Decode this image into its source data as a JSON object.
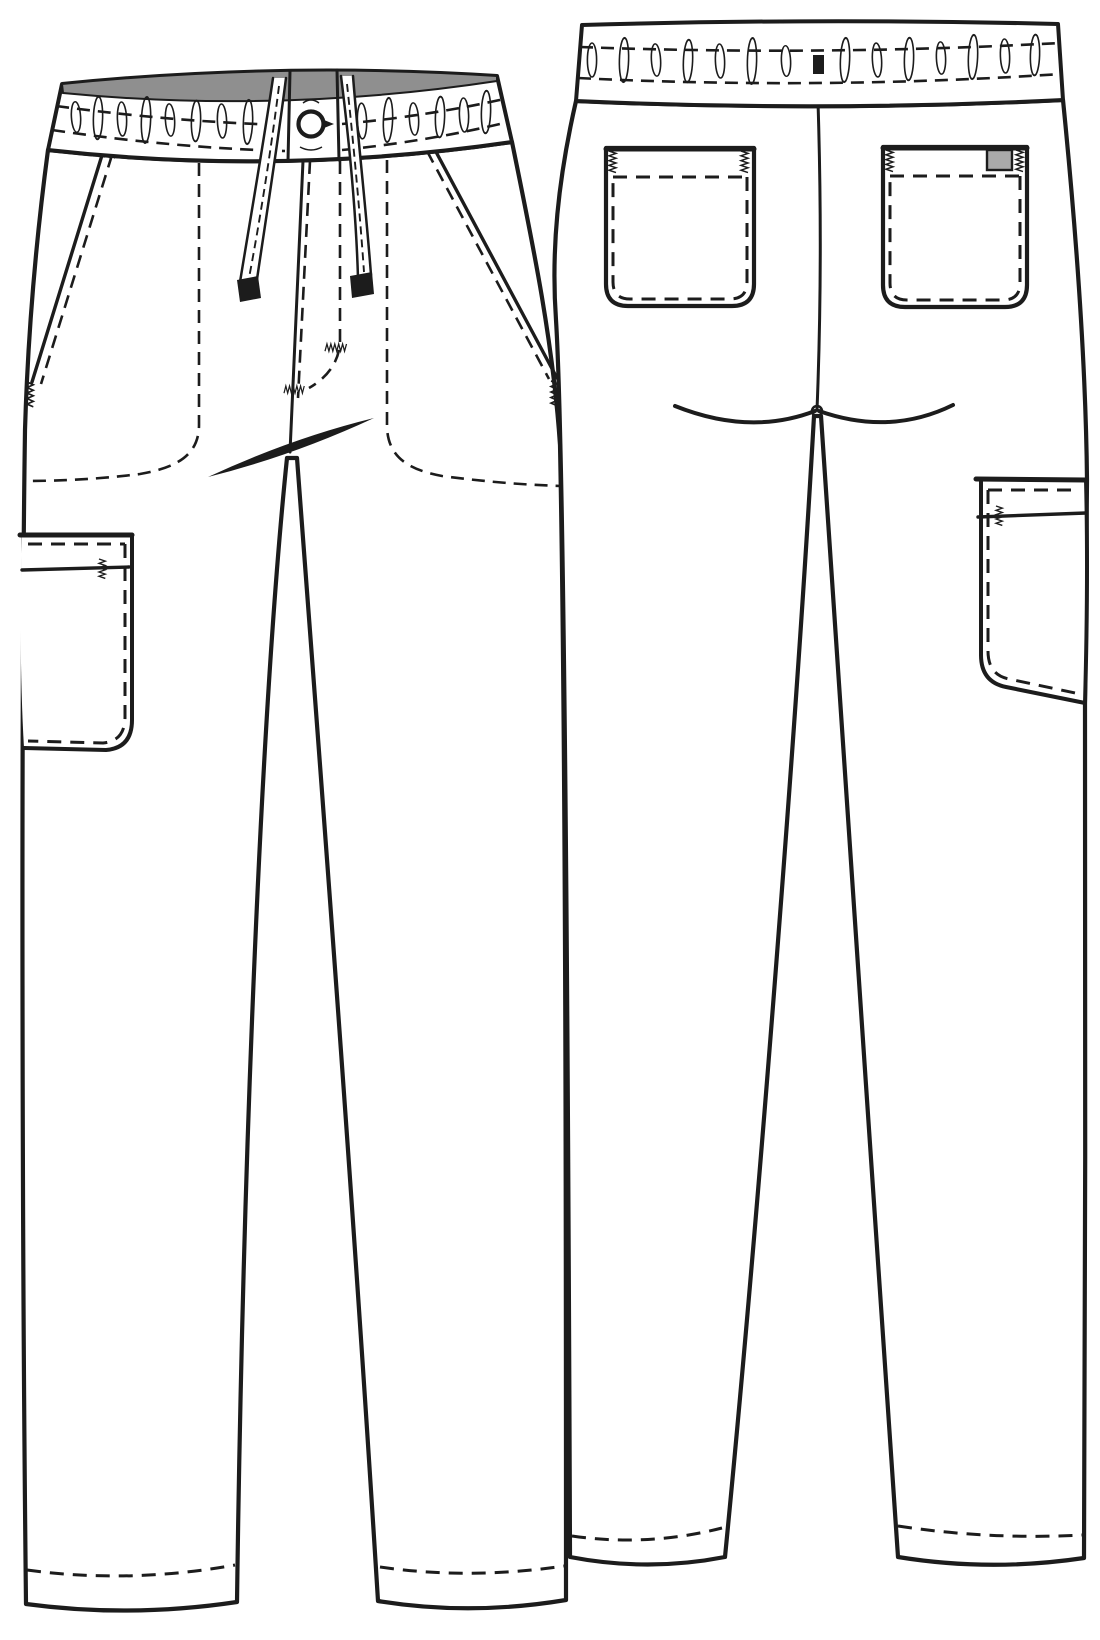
{
  "document": {
    "type": "technical-flat-sketch",
    "garment": "drawstring elastic-waist cargo scrub pants",
    "views": [
      {
        "id": "front",
        "label": "front view"
      },
      {
        "id": "back",
        "label": "back view"
      }
    ]
  },
  "colors": {
    "background": "#ffffff",
    "ink": "#1c1c1c",
    "waistbandInner": "#8f8f8f",
    "labelPatch": "#a9a9a9",
    "drawstringTip": "#1c1c1c",
    "hangLoop": "#1c1c1c"
  },
  "front": {
    "parts": [
      "elastic shirred waistband",
      "gray inner waistband facing",
      "two-cord drawstring with dark aglets",
      "round grommet button at center front",
      "fly with J-topstitch and bartacks",
      "slant side-entry pockets with bartacks",
      "left-side cargo pocket with welt opening",
      "side pocket bags (hidden stitch lines)",
      "tapered legs with stitched hems"
    ]
  },
  "back": {
    "parts": [
      "elastic shirred waistband",
      "center-back hang loop",
      "center back seam",
      "curved seat seams",
      "two patch pockets with corner bartacks",
      "woven label on right patch pocket",
      "right-side cargo pocket with welt opening",
      "tapered legs with stitched hems"
    ]
  }
}
